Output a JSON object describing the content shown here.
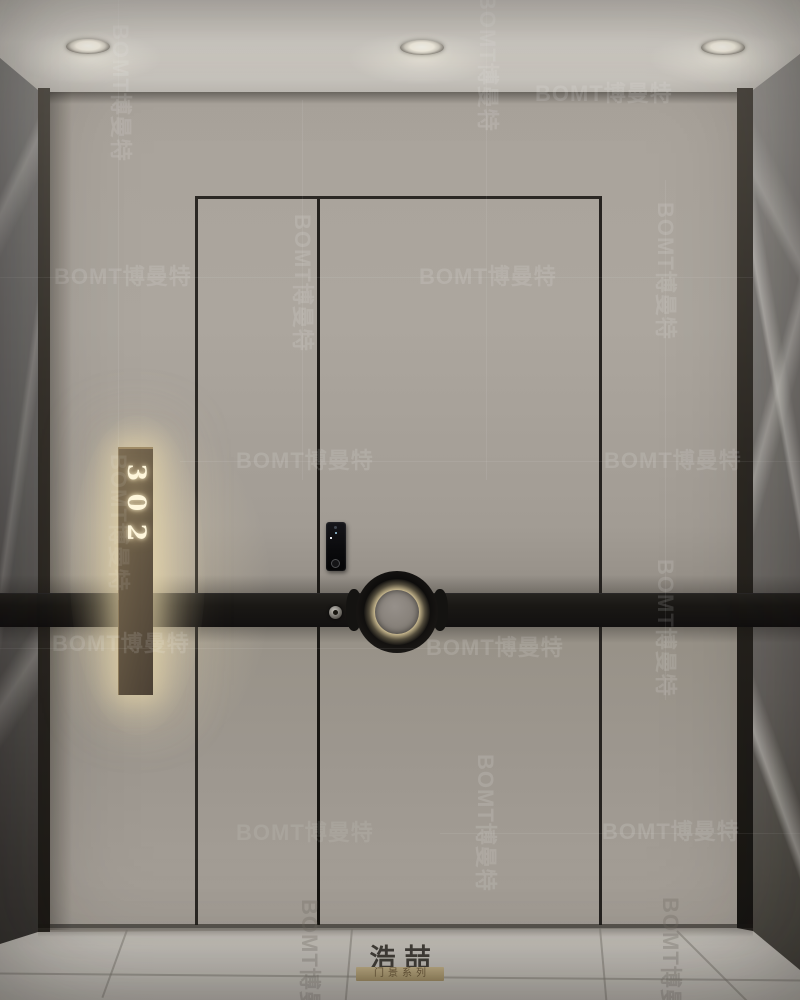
{
  "scene": {
    "type": "interior-render",
    "subject": "apartment entrance door with smart lock and backlit room sign",
    "watermark": {
      "text": "BOMT博曼特"
    },
    "door_sign": {
      "number": "302",
      "digits": [
        "3",
        "0",
        "2"
      ]
    },
    "brand": {
      "name": "浩喆",
      "series_label": "门景系列"
    },
    "ceiling": {
      "recessed_lights": 3
    },
    "palette": {
      "ceiling": "#d6d2cb",
      "wall": "#a8a29a",
      "door": "#a19b93",
      "band": "#181614",
      "glow": "#ecd9a8",
      "plaque": "#6b5d48",
      "floor": "#c7c3bc",
      "marble_left": "#636160",
      "marble_right": "#7c7874"
    }
  }
}
